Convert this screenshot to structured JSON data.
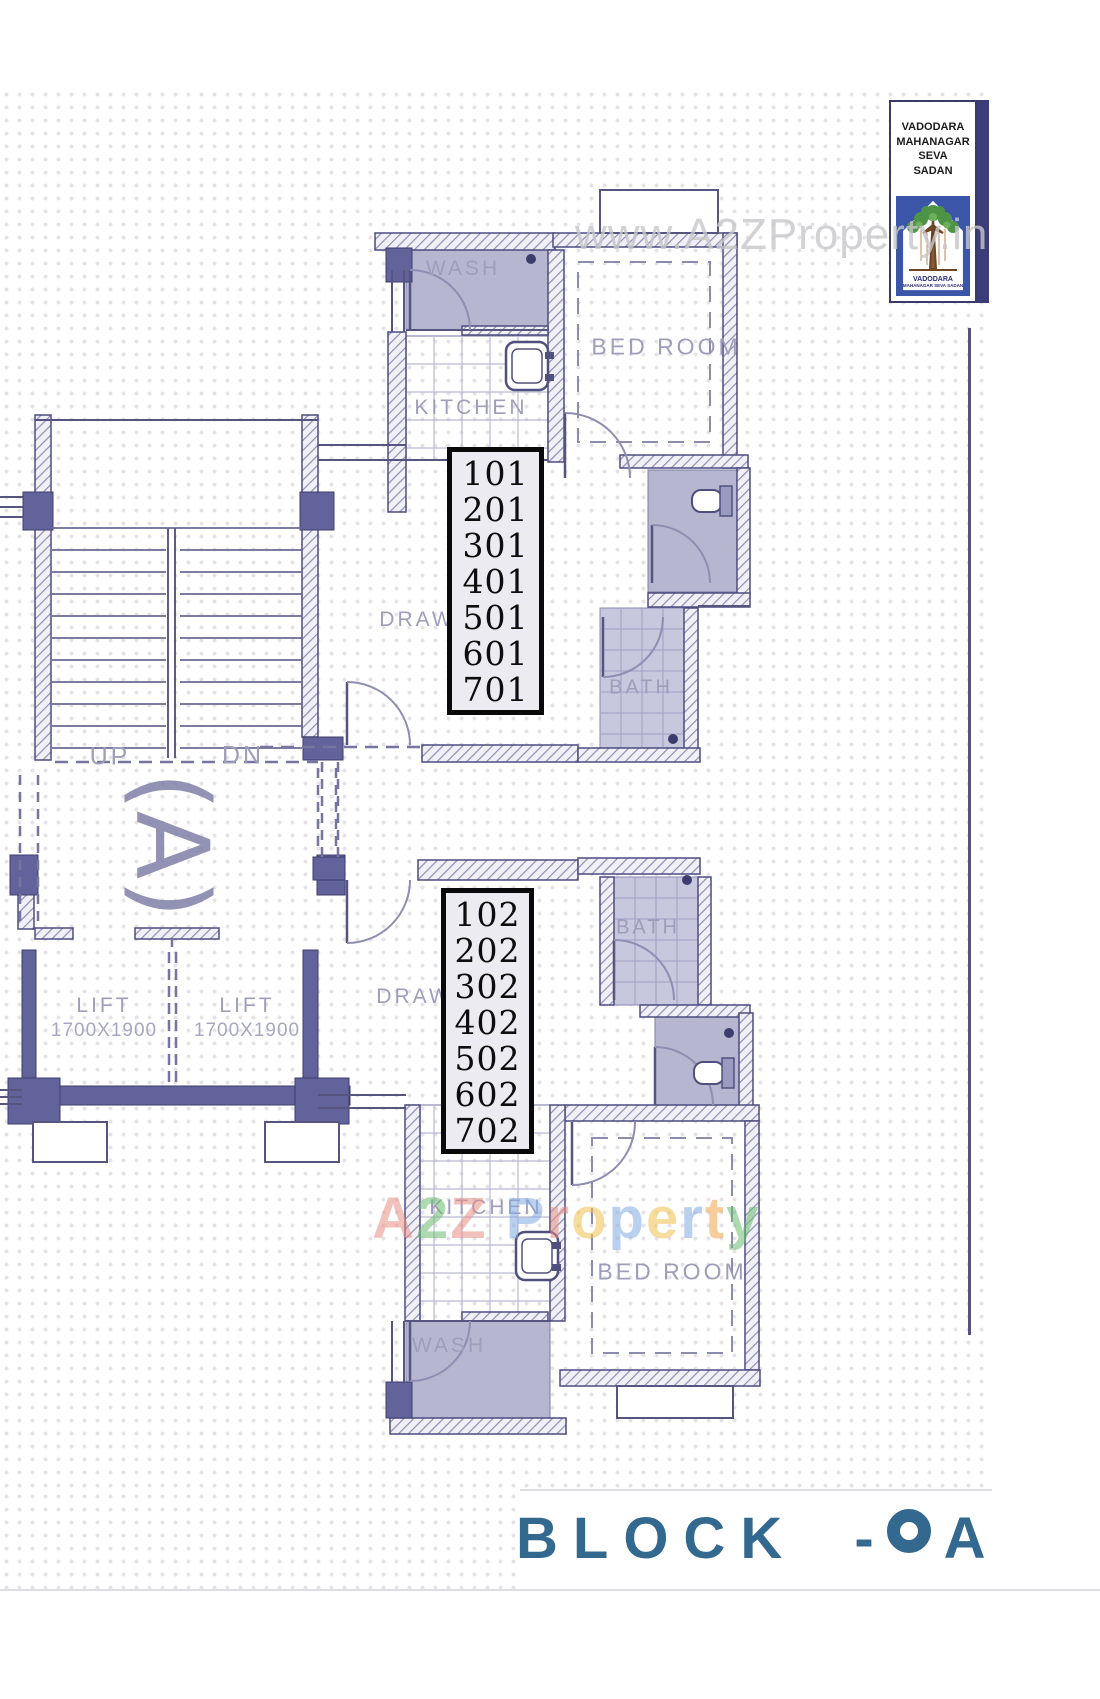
{
  "watermarks": {
    "site": "www.A2ZProperty.in",
    "brand_letters": [
      {
        "ch": "A",
        "color": "#e98f85"
      },
      {
        "ch": "2",
        "color": "#6cbd71"
      },
      {
        "ch": "Z",
        "color": "#e98f85"
      },
      {
        "ch": " ",
        "color": "#ffffff"
      },
      {
        "ch": "P",
        "color": "#83abe3"
      },
      {
        "ch": "r",
        "color": "#e98f85"
      },
      {
        "ch": "o",
        "color": "#f2c24e"
      },
      {
        "ch": "p",
        "color": "#83abe3"
      },
      {
        "ch": "e",
        "color": "#f2c24e"
      },
      {
        "ch": "r",
        "color": "#83abe3"
      },
      {
        "ch": "t",
        "color": "#f2a54e"
      },
      {
        "ch": "y",
        "color": "#6cbd71"
      }
    ]
  },
  "logo": {
    "org_lines": [
      "VADODARA",
      "MAHANAGAR",
      "SEVA",
      "SADAN"
    ],
    "emblem_caption_line1": "VADODARA",
    "emblem_caption_line2": "MAHANAGAR SEVA SADAN"
  },
  "plan": {
    "rooms": {
      "wash_1": "WASH",
      "kitchen_1": "KITCHEN",
      "bedroom_1": "BED ROOM",
      "draw_1": "DRAW",
      "bath_1": "BATH",
      "bath_2": "BATH",
      "draw_2": "DRAW",
      "kitchen_2": "KITCHEN",
      "wash_2": "WASH",
      "bedroom_2": "BED ROOM"
    },
    "stairs": {
      "up": "UP",
      "down": "DN"
    },
    "core_label": "(A)",
    "lifts": [
      {
        "name": "LIFT",
        "size": "1700X1900"
      },
      {
        "name": "LIFT",
        "size": "1700X1900"
      }
    ],
    "unit_stacks": [
      {
        "units": [
          "101",
          "201",
          "301",
          "401",
          "501",
          "601",
          "701"
        ]
      },
      {
        "units": [
          "102",
          "202",
          "302",
          "402",
          "502",
          "602",
          "702"
        ]
      }
    ]
  },
  "footer": {
    "title": "BLOCK - A"
  },
  "colors": {
    "wall": "#5c5c8c",
    "accent": "#33688f",
    "shade": "#b6b6d0",
    "grid_dot": "#e6e2e7"
  }
}
